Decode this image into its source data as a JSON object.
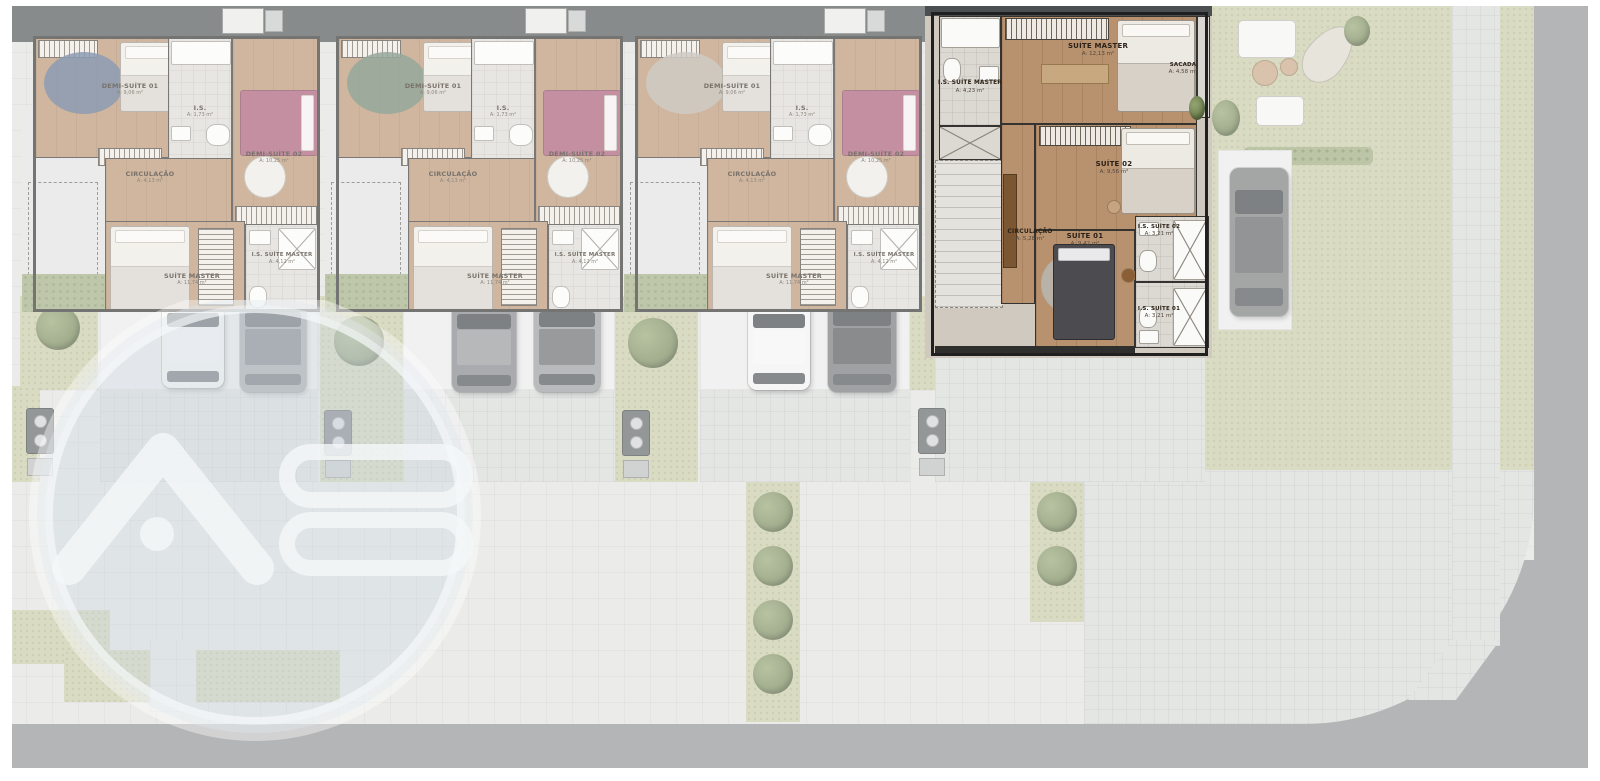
{
  "watermark": {
    "letters": "AB"
  },
  "units": [
    {
      "id": "unit-1",
      "accent": "#51688c",
      "rooms": [
        {
          "name": "DEMI-SUÍTE 01",
          "area": "A: 9,06 m²"
        },
        {
          "name": "I.S.",
          "area": "A: 1,73 m²"
        },
        {
          "name": "DEMI-SUÍTE 02",
          "area": "A: 10,25 m²"
        },
        {
          "name": "CIRCULAÇÃO",
          "area": "A: 4,13 m²"
        },
        {
          "name": "SUÍTE MASTER",
          "area": "A: 11,74 m²"
        },
        {
          "name": "I.S. SUÍTE MASTER",
          "area": "A: 4,12 m²"
        }
      ]
    },
    {
      "id": "unit-2",
      "accent": "#5f7a68",
      "rooms": [
        {
          "name": "DEMI-SUÍTE 01",
          "area": "A: 9,06 m²"
        },
        {
          "name": "I.S.",
          "area": "A: 1,73 m²"
        },
        {
          "name": "DEMI-SUÍTE 02",
          "area": "A: 10,25 m²"
        },
        {
          "name": "CIRCULAÇÃO",
          "area": "A: 4,13 m²"
        },
        {
          "name": "SUÍTE MASTER",
          "area": "A: 11,74 m²"
        },
        {
          "name": "I.S. SUÍTE MASTER",
          "area": "A: 4,12 m²"
        }
      ]
    },
    {
      "id": "unit-3",
      "accent": "#b6b0a6",
      "rooms": [
        {
          "name": "DEMI-SUÍTE 01",
          "area": "A: 9,06 m²"
        },
        {
          "name": "I.S.",
          "area": "A: 1,73 m²"
        },
        {
          "name": "DEMI-SUÍTE 02",
          "area": "A: 10,25 m²"
        },
        {
          "name": "CIRCULAÇÃO",
          "area": "A: 4,13 m²"
        },
        {
          "name": "SUÍTE MASTER",
          "area": "A: 11,74 m²"
        },
        {
          "name": "I.S. SUÍTE MASTER",
          "area": "A: 4,12 m²"
        }
      ]
    },
    {
      "id": "unit-4",
      "accent": "#b8916e",
      "rooms": [
        {
          "name": "I.S. SUÍTE MASTER",
          "area": "A: 4,23 m²"
        },
        {
          "name": "SUÍTE MASTER",
          "area": "A: 12,13 m²"
        },
        {
          "name": "SACADA",
          "area": "A: 4,58 m²"
        },
        {
          "name": "SUÍTE 02",
          "area": "A: 9,56 m²"
        },
        {
          "name": "CIRCULAÇÃO",
          "area": "A: 5,28 m²"
        },
        {
          "name": "SUÍTE 01",
          "area": "A: 9,42 m²"
        },
        {
          "name": "I.S. SUÍTE 02",
          "area": "A: 3,21 m²"
        },
        {
          "name": "I.S. SUÍTE 01",
          "area": "A: 3,21 m²"
        }
      ]
    }
  ],
  "colors": {
    "wood": "#b8916e",
    "tile": "#dcd9d3",
    "lawn": "#c6c8a3",
    "road": "#8d8f91",
    "pavement": "#e1e2e0",
    "bedpink": "#a85672"
  }
}
